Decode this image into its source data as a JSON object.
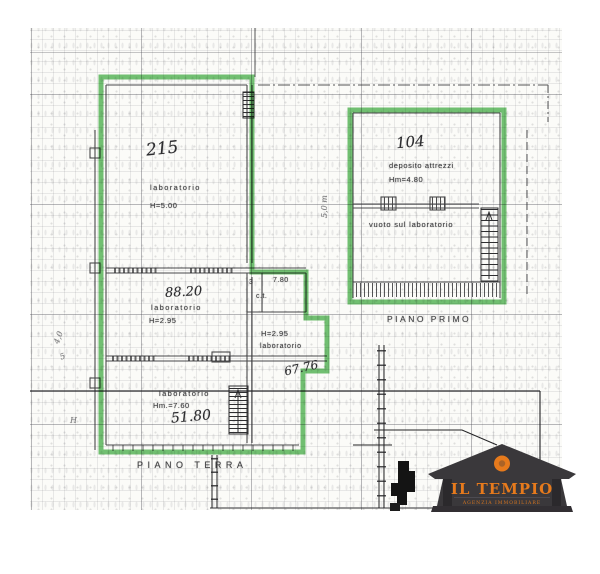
{
  "plan": {
    "highlight_color": "#5ab85c",
    "ground_floor": {
      "floor_label": "PIANO TERRA",
      "main_room": {
        "area": "215",
        "name": "laboratorio",
        "height": "H=5.00"
      },
      "mid_room": {
        "area": "88.20",
        "name": "laboratorio",
        "height": "H=2.95"
      },
      "ct_room": {
        "num": "3",
        "width": "7.80",
        "name": "c.t."
      },
      "right_room": {
        "height": "H=2.95",
        "name": "laboratorio",
        "area": "67.76"
      },
      "low_room": {
        "name": "laboratorio",
        "height": "Hm.=7.60",
        "area": "51.80"
      }
    },
    "first_floor": {
      "floor_label": "PIANO PRIMO",
      "room": {
        "area": "104",
        "name": "deposito attrezzi",
        "height": "Hm=4.80"
      },
      "void_label": "vuoto sul laboratorio",
      "side_dimension": "5,0 m"
    },
    "margin_marks": {
      "m1": "4,0",
      "m2": "5",
      "m3": "H"
    }
  },
  "logo": {
    "title": "IL TEMPIO",
    "subtitle": "AGENZIA IMMOBILIARE",
    "accent_color": "#e67a1c",
    "body_color": "#3a383b"
  }
}
